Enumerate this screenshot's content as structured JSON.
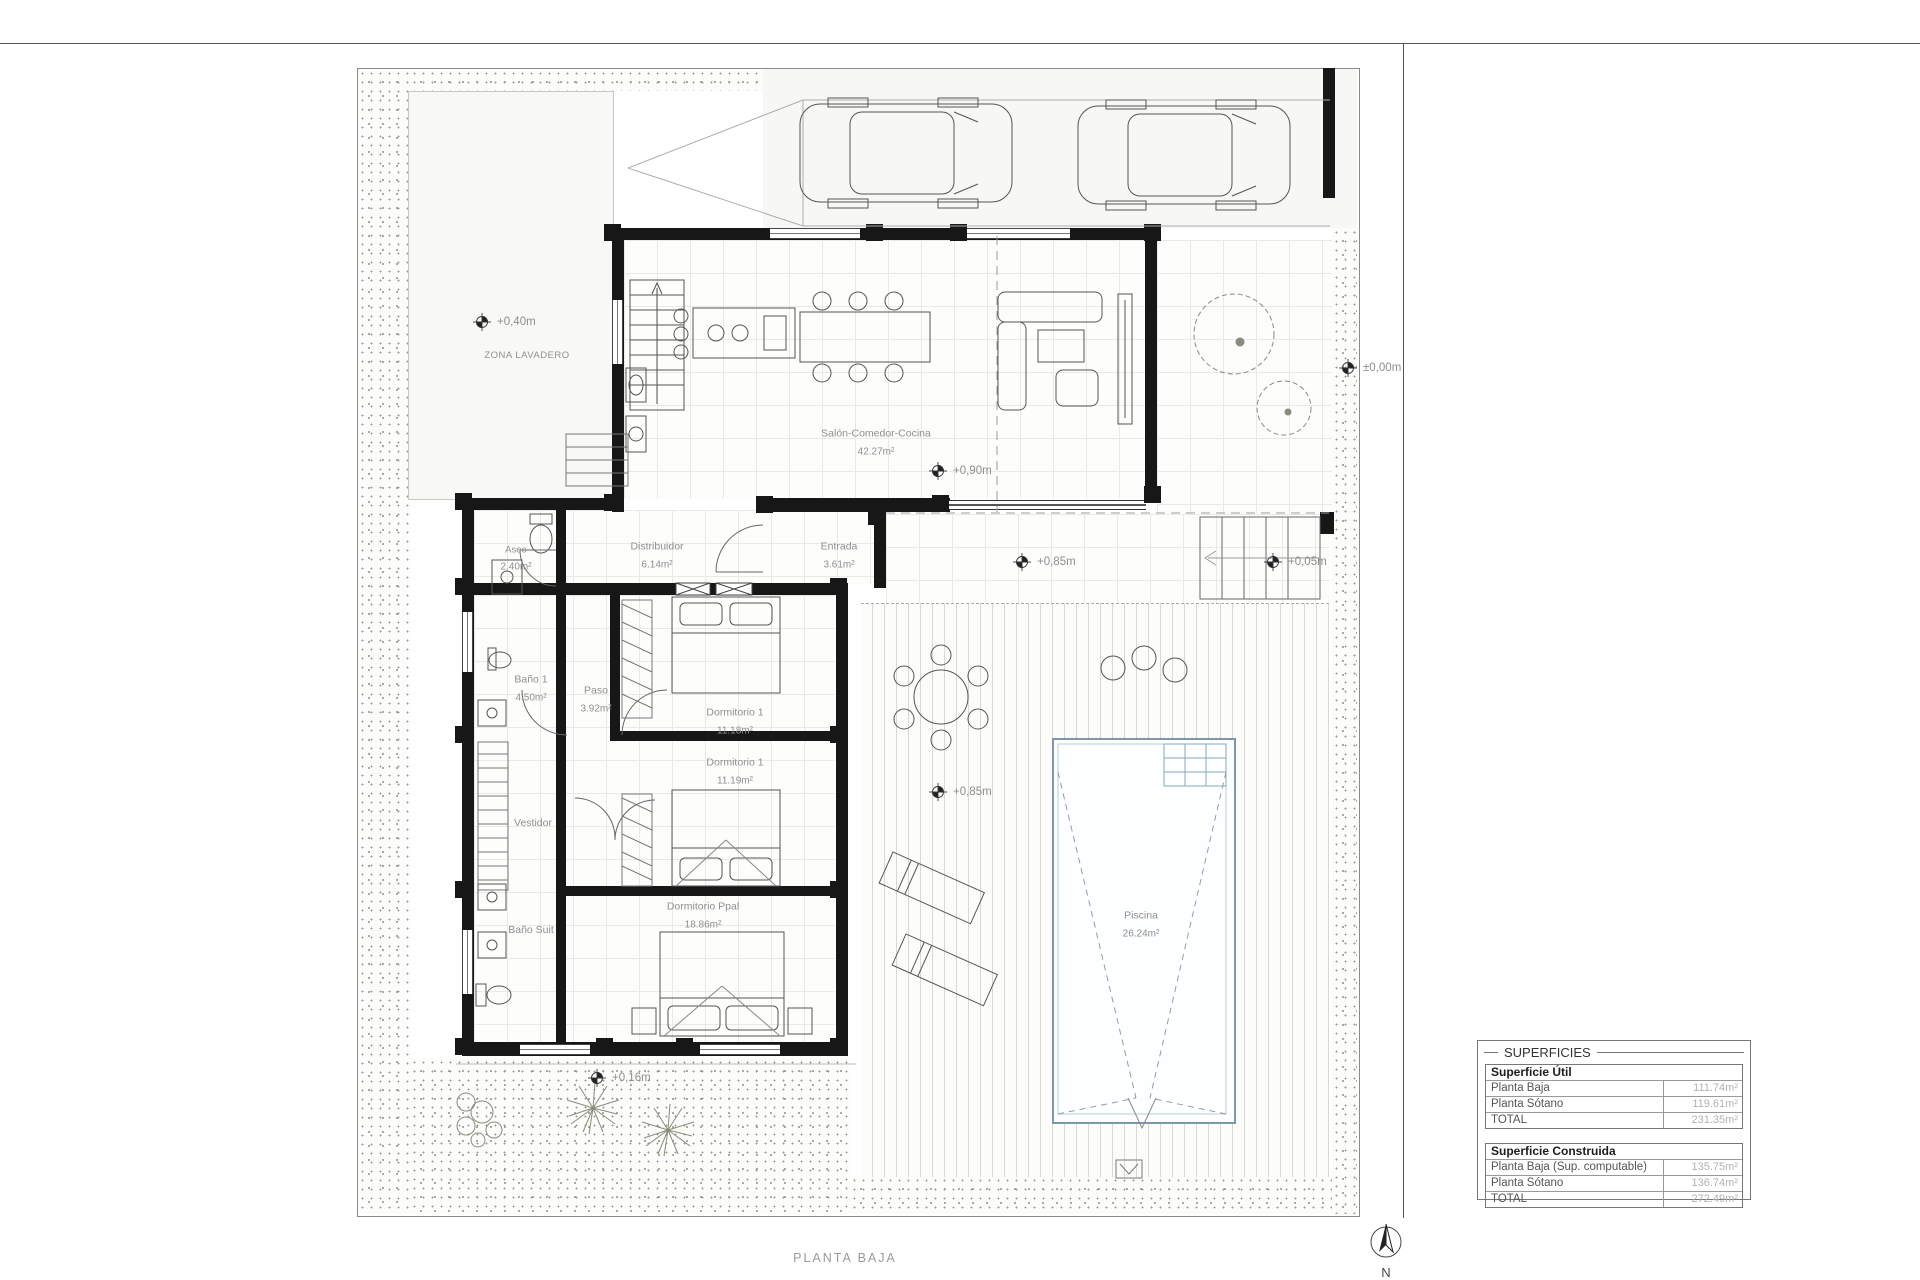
{
  "sheet": {
    "title": "PLANTA BAJA",
    "north_label": "N"
  },
  "areas": {
    "zona_lavadero": "ZONA LAVADERO"
  },
  "rooms": [
    {
      "name": "Salón-Comedor-Cocina",
      "area": "42.27m²"
    },
    {
      "name": "Distribuidor",
      "area": "6.14m²"
    },
    {
      "name": "Entrada",
      "area": "3.61m²"
    },
    {
      "name": "Aseo",
      "area": "2.40m²"
    },
    {
      "name": "Baño 1",
      "area": "4.50m²"
    },
    {
      "name": "Paso",
      "area": "3.92m²"
    },
    {
      "name": "Dormitorio 1",
      "area": "11.18m²"
    },
    {
      "name": "Dormitorio 1",
      "area": "11.19m²"
    },
    {
      "name": "Vestidor",
      "area": ""
    },
    {
      "name": "Baño Suit",
      "area": ""
    },
    {
      "name": "Dormitorio Ppal",
      "area": "18.86m²"
    },
    {
      "name": "Piscina",
      "area": "26.24m²"
    }
  ],
  "markers": [
    {
      "text": "+0,40m"
    },
    {
      "text": "±0,00m"
    },
    {
      "text": "+0,90m"
    },
    {
      "text": "+0,85m"
    },
    {
      "text": "+0,05m"
    },
    {
      "text": "+0,85m"
    },
    {
      "text": "+0,16m"
    }
  ],
  "superficies": {
    "title": "SUPERFICIES",
    "sections": [
      {
        "header": "Superficie Útil",
        "rows": [
          {
            "label": "Planta Baja",
            "value": "111.74m²"
          },
          {
            "label": "Planta Sótano",
            "value": "119.61m²"
          },
          {
            "label": "TOTAL",
            "value": "231.35m²"
          }
        ]
      },
      {
        "header": "Superficie Construida",
        "rows": [
          {
            "label": "Planta Baja (Sup. computable)",
            "value": "135.75m²"
          },
          {
            "label": "Planta Sótano",
            "value": "136.74m²"
          },
          {
            "label": "TOTAL",
            "value": "272.49m²"
          }
        ]
      }
    ]
  }
}
